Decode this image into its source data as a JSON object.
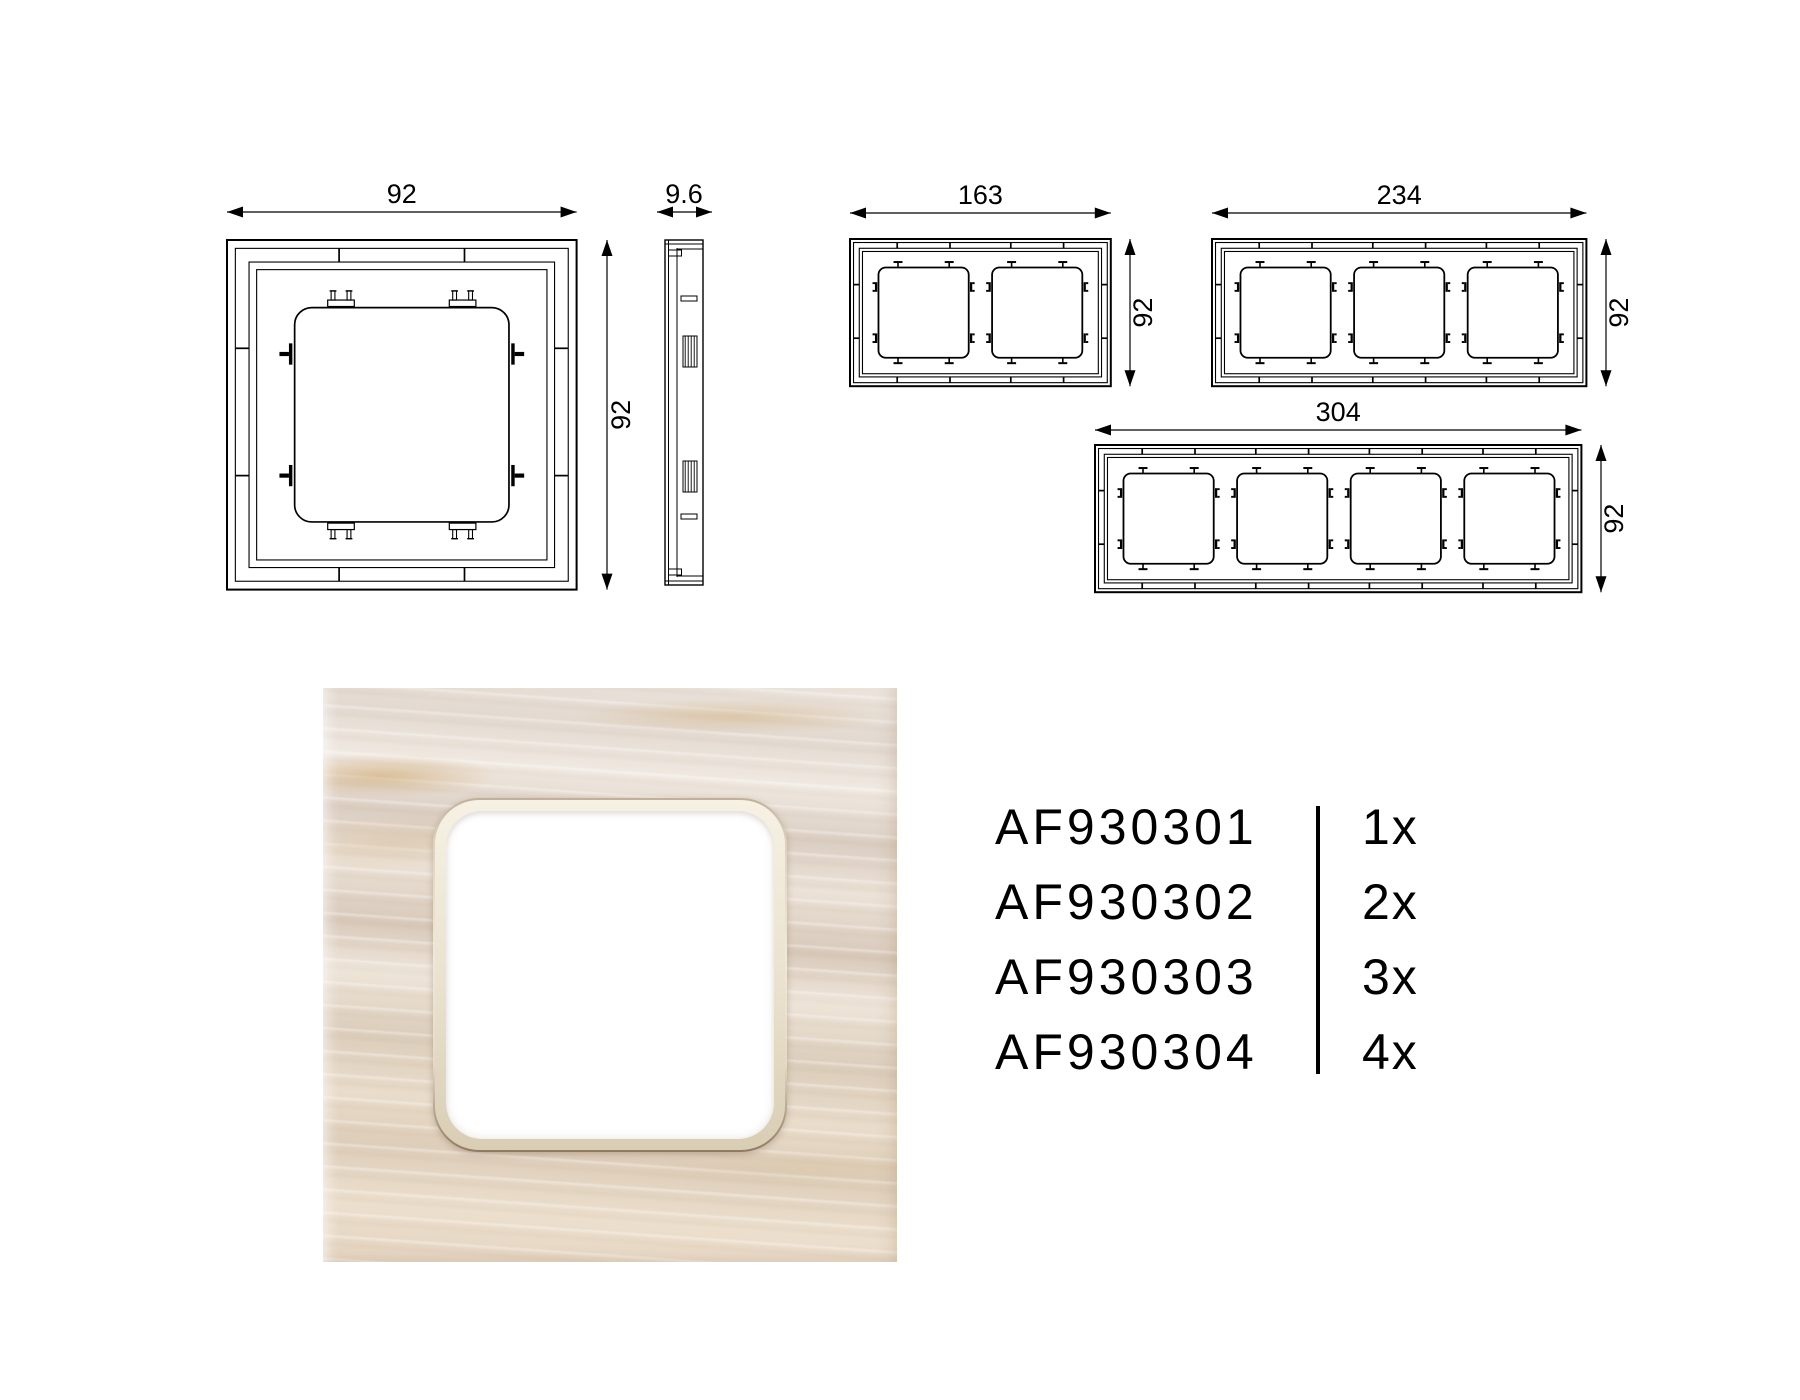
{
  "page": {
    "background": "#ffffff",
    "line_color": "#000000"
  },
  "drawings": [
    {
      "id": "front-1gang",
      "type": "front",
      "gangs": 1,
      "width_label": "92",
      "height_label": "92"
    },
    {
      "id": "side",
      "type": "side",
      "thickness_label": "9.6"
    },
    {
      "id": "front-2gang",
      "type": "front",
      "gangs": 2,
      "width_label": "163",
      "height_label": "92"
    },
    {
      "id": "front-3gang",
      "type": "front",
      "gangs": 3,
      "width_label": "234",
      "height_label": "92"
    },
    {
      "id": "front-4gang",
      "type": "front",
      "gangs": 4,
      "width_label": "304",
      "height_label": "92"
    }
  ],
  "photo": {
    "finish_colors": {
      "base": "#e7ded4",
      "streak_light": "#f1ebe4",
      "streak_dark": "#d5c6b8",
      "streak_gold": "#d3ad7c",
      "bezel": "#ece4d2",
      "bezel_line": "#9b8769",
      "inner": "#ffffff"
    }
  },
  "products": {
    "rows": [
      {
        "code": "AF930301",
        "qty": "1x"
      },
      {
        "code": "AF930302",
        "qty": "2x"
      },
      {
        "code": "AF930303",
        "qty": "3x"
      },
      {
        "code": "AF930304",
        "qty": "4x"
      }
    ]
  }
}
